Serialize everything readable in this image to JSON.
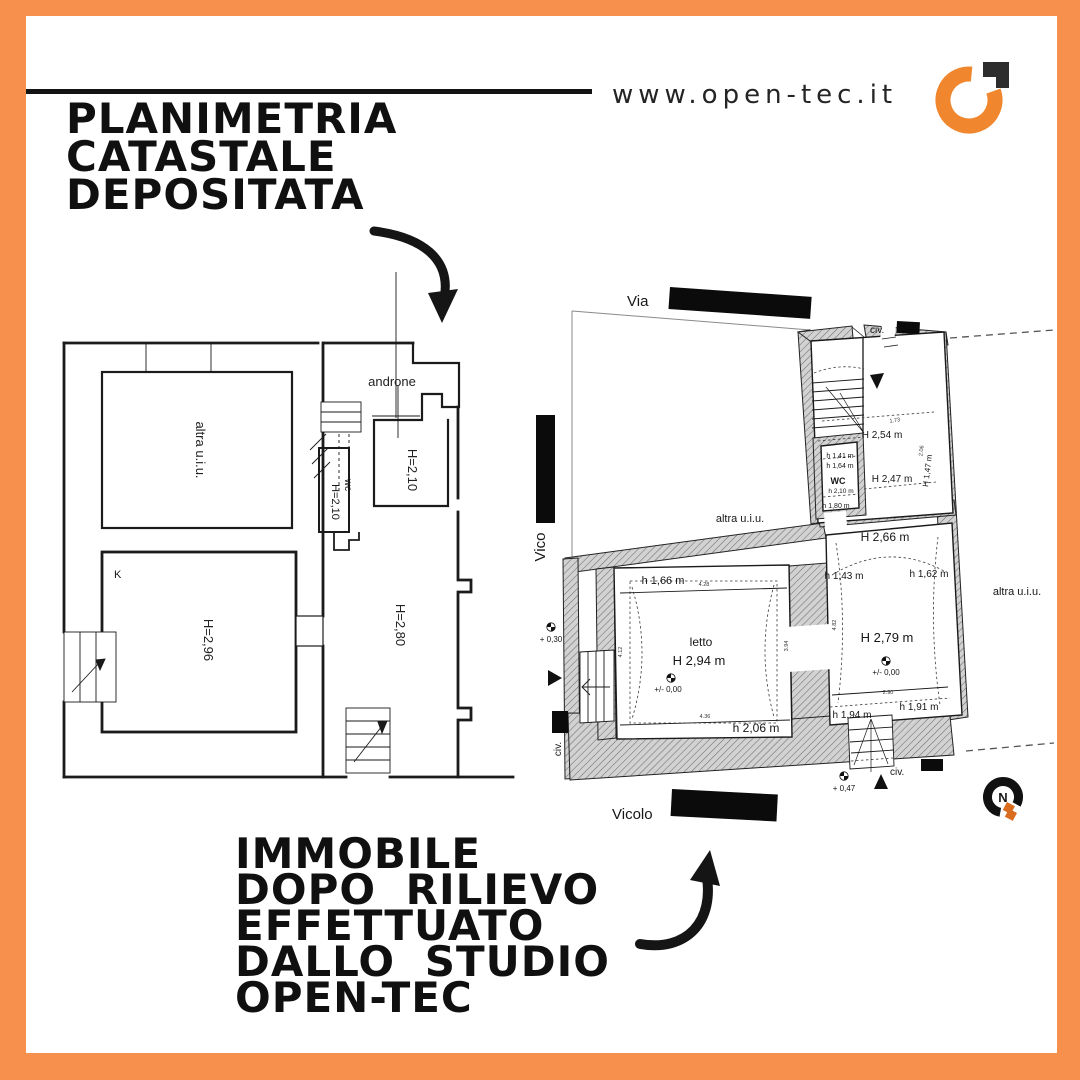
{
  "colors": {
    "accent_orange": "#F78F4D",
    "ink": "#141414",
    "logo_orange": "#F0872E",
    "logo_dark": "#2D2D2D",
    "compass_orange": "#D96C1E"
  },
  "header": {
    "website": "www.open-tec.it"
  },
  "title": {
    "line1": "PLANIMETRIA",
    "line2": "CATASTALE",
    "line3": "DEPOSITATA"
  },
  "caption": {
    "line1": "IMMOBILE",
    "line2": "DOPO RILIEVO",
    "line3": "EFFETTUATO",
    "line4": "DALLO STUDIO",
    "line5": "OPEN-TEC"
  },
  "plan_left": {
    "room_other_unit": "altra u.i.u.",
    "androne": "androne",
    "wc": "wc",
    "wc_height": "H=2,10",
    "hall_height": "H=2,10",
    "kitchen": "K",
    "kitchen_height": "H=2,96",
    "living_height": "H=2,80"
  },
  "plan_right": {
    "street_top": "Via",
    "street_left": "Vico",
    "street_bottom": "Vicolo",
    "civic": "civ.",
    "other_unit": "altra u.i.u.",
    "h254": "H 2,54 m",
    "h141": "h 1,41 m",
    "h164": "h 1,64 m",
    "wc": "WC",
    "wc_h": "h 2,10 m",
    "h180": "h 1,80 m",
    "h247": "H 2,47 m",
    "h147": "H 1,47 m",
    "h266": "H 2,66 m",
    "h143": "h 1,43 m",
    "h162": "h 1,62 m",
    "letto": "letto",
    "letto_h": "H 2,94 m",
    "h166": "h 1,66 m",
    "h206": "h 2,06 m",
    "h279": "H 2,79 m",
    "h194": "h 1,94 m",
    "h191": "h 1,91 m",
    "lvl_zero": "+/- 0,00",
    "lvl_030": "+ 0,30",
    "lvl_047": "+ 0,47",
    "d428": "4.28",
    "d412": "4.12",
    "d394": "3.94",
    "d436": "4.36",
    "d482": "4.82",
    "d290": "2.90",
    "d206": "2.06",
    "d173": "1.73"
  },
  "compass": {
    "north": "N"
  }
}
